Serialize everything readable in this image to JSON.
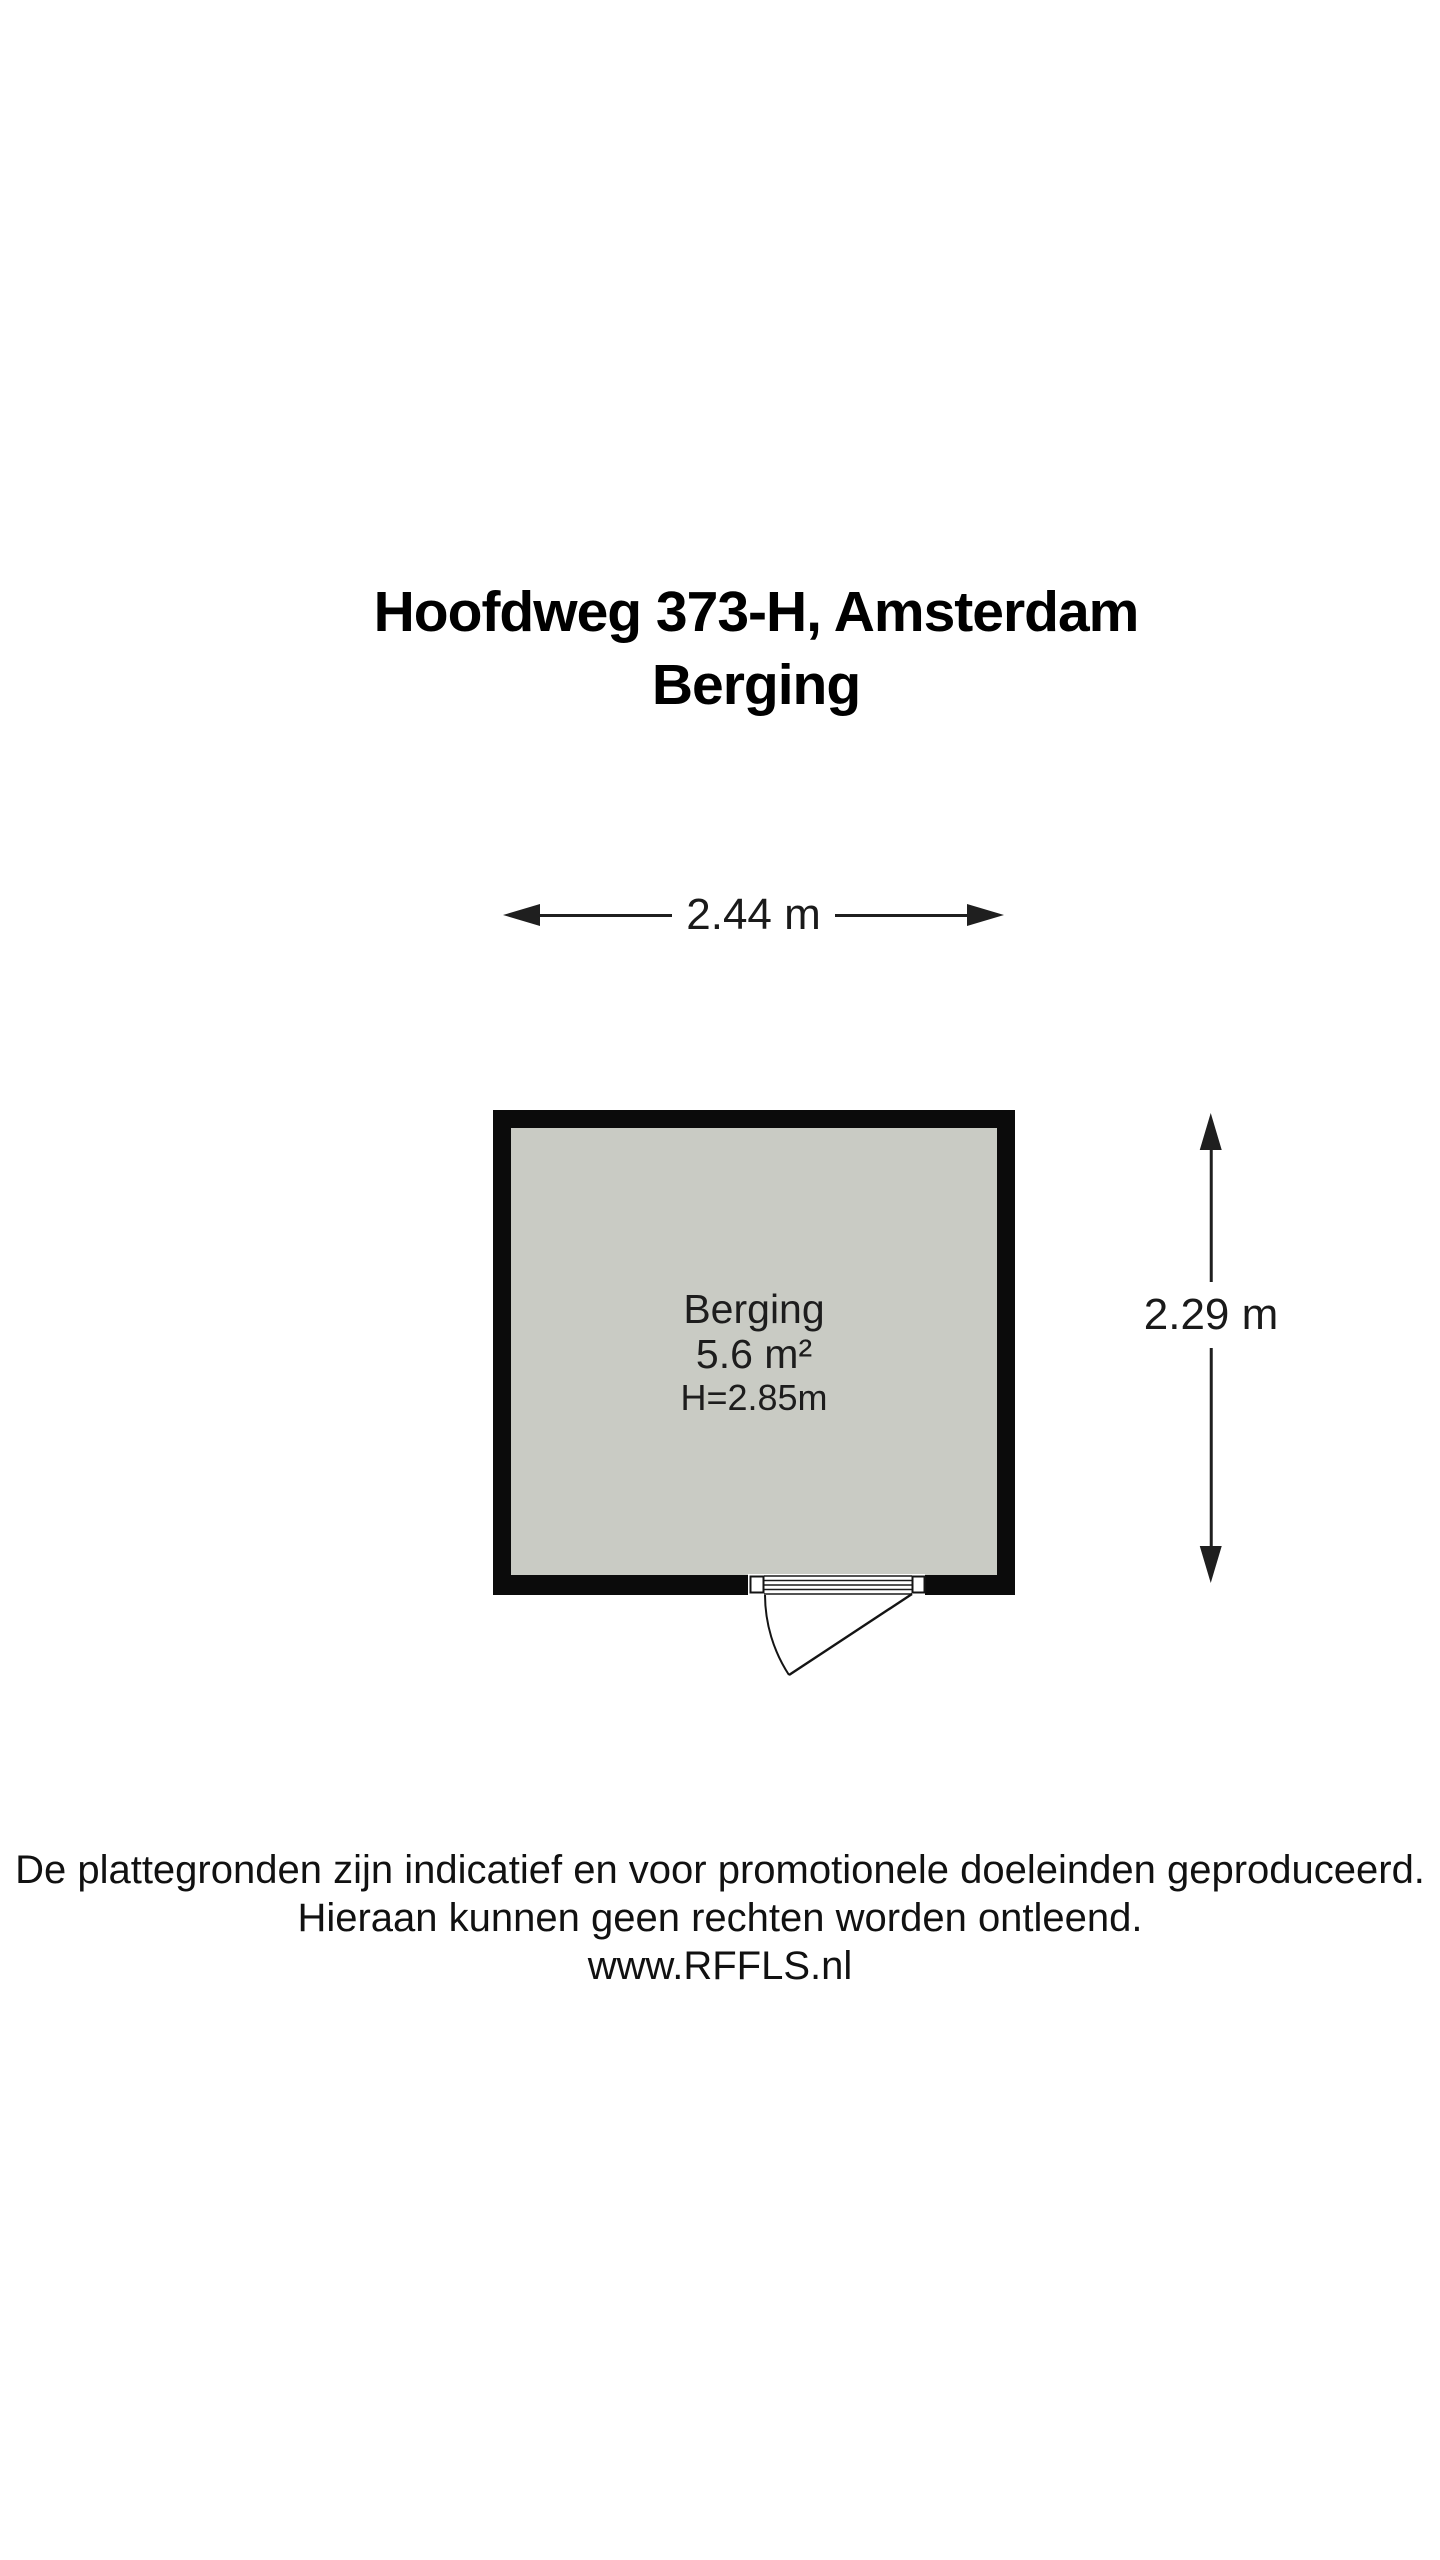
{
  "title": {
    "line1": "Hoofdweg 373-H, Amsterdam",
    "line2": "Berging"
  },
  "dimensions": {
    "width_label": "2.44 m",
    "height_label": "2.29 m"
  },
  "room": {
    "name": "Berging",
    "area_label": "5.6 m²",
    "ceiling_height_label": "H=2.85m"
  },
  "colors": {
    "wall": "#0b0b0b",
    "floor_fill": "#c9cbc4",
    "dimension_line": "#1f1f1f",
    "door_outline": "#141414"
  },
  "footer": {
    "disclaimer_line1": "De plattegronden zijn indicatief en voor promotionele doeleinden geproduceerd.",
    "disclaimer_line2": "Hieraan kunnen geen rechten worden ontleend.",
    "website": "www.RFFLS.nl"
  }
}
